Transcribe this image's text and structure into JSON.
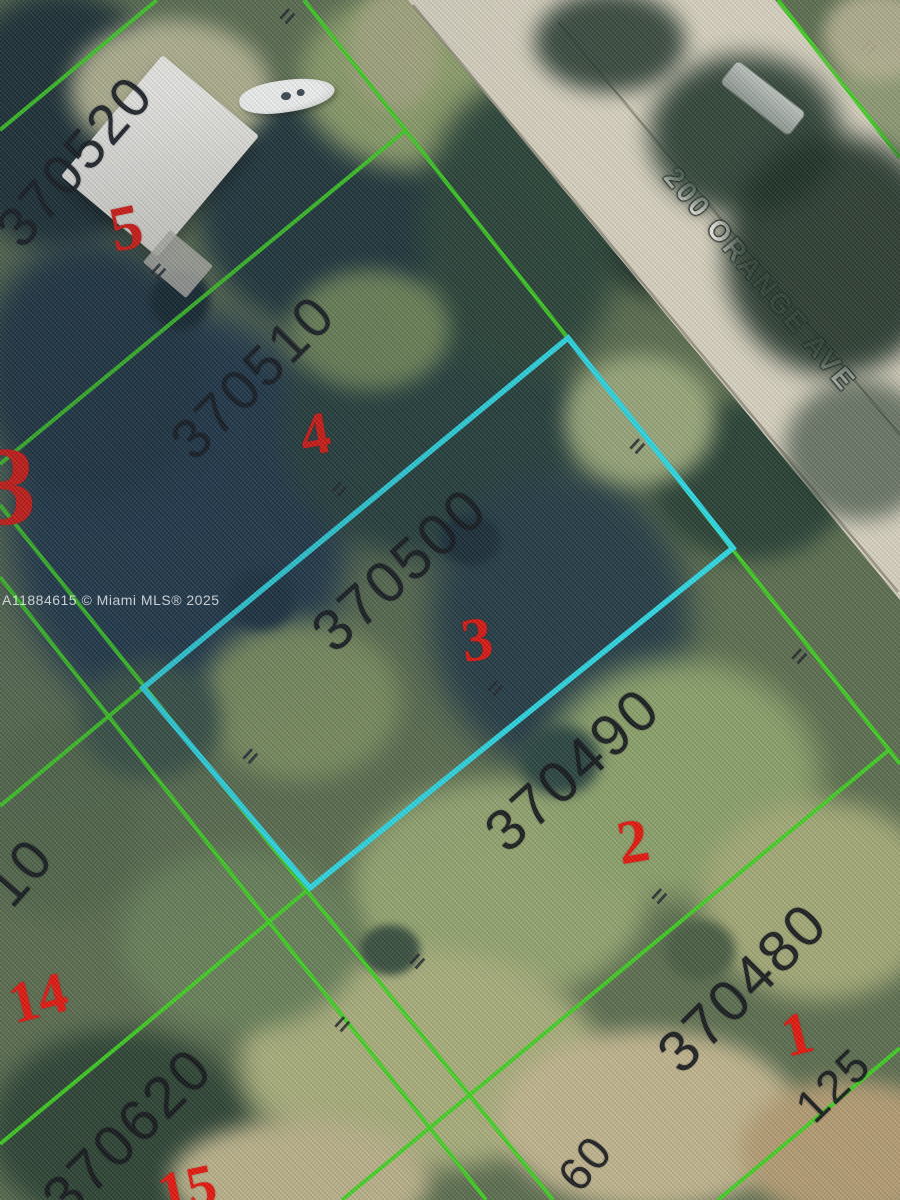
{
  "map": {
    "street_label": "200 ORANGE AVE",
    "watermark": "A11884615 © Miami MLS® 2025",
    "colors": {
      "parcel_line": "#3fd321",
      "highlight": "#2fd9e4",
      "lot_red": "#e3180f",
      "parcel_text": "#15181c",
      "road": "#d7d1bf",
      "road_seam": "rgba(95,90,78,0.5)"
    },
    "parcel_numbers": [
      {
        "t": "370520",
        "x": 75,
        "y": 161,
        "r": -49,
        "s": 56
      },
      {
        "t": "370510",
        "x": 253,
        "y": 377,
        "r": -45,
        "s": 56
      },
      {
        "t": "370500",
        "x": 400,
        "y": 570,
        "r": -42,
        "s": 58
      },
      {
        "t": "370490",
        "x": 573,
        "y": 770,
        "r": -42,
        "s": 58
      },
      {
        "t": "370480",
        "x": 743,
        "y": 988,
        "r": -45,
        "s": 58
      },
      {
        "t": "370620",
        "x": 128,
        "y": 1133,
        "r": -45,
        "s": 58
      },
      {
        "t": "10",
        "x": 20,
        "y": 872,
        "r": -49,
        "s": 56
      }
    ],
    "dimensions": [
      {
        "t": "125",
        "x": 833,
        "y": 1085,
        "r": -44,
        "s": 46
      },
      {
        "t": "60",
        "x": 585,
        "y": 1163,
        "r": -50,
        "s": 46
      }
    ],
    "lot_numbers": [
      {
        "t": "5",
        "x": 126,
        "y": 228,
        "r": -12,
        "s": 64
      },
      {
        "t": "4",
        "x": 315,
        "y": 434,
        "r": -10,
        "s": 60
      },
      {
        "t": "3",
        "x": 477,
        "y": 640,
        "r": -8,
        "s": 62
      },
      {
        "t": "2",
        "x": 633,
        "y": 842,
        "r": -10,
        "s": 62
      },
      {
        "t": "1",
        "x": 797,
        "y": 1034,
        "r": -14,
        "s": 60
      },
      {
        "t": "14",
        "x": 38,
        "y": 998,
        "r": -14,
        "s": 58
      },
      {
        "t": "15",
        "x": 187,
        "y": 1189,
        "r": -12,
        "s": 58
      },
      {
        "t": "3",
        "x": 8,
        "y": 487,
        "r": 0,
        "s": 112
      }
    ],
    "corner_marks": [
      {
        "x": 287,
        "y": 16
      },
      {
        "x": 869,
        "y": 47
      },
      {
        "x": 158,
        "y": 271
      },
      {
        "x": 339,
        "y": 489
      },
      {
        "x": 637,
        "y": 446
      },
      {
        "x": 495,
        "y": 688
      },
      {
        "x": 799,
        "y": 656
      },
      {
        "x": 250,
        "y": 756
      },
      {
        "x": 659,
        "y": 896
      },
      {
        "x": 417,
        "y": 961
      },
      {
        "x": 342,
        "y": 1024
      }
    ],
    "road": {
      "points": "408,0 775,0 900,156 900,600"
    },
    "road_seams": [
      {
        "x1": 413,
        "y1": 5,
        "x2": 898,
        "y2": 592
      },
      {
        "x1": 558,
        "y1": 22,
        "x2": 900,
        "y2": 435
      }
    ],
    "boundary_lines": [
      {
        "x1": 157,
        "y1": 0,
        "x2": 0,
        "y2": 130
      },
      {
        "x1": 406,
        "y1": 130,
        "x2": 0,
        "y2": 464
      },
      {
        "x1": 143,
        "y1": 688,
        "x2": 0,
        "y2": 806
      },
      {
        "x1": 310,
        "y1": 888,
        "x2": 0,
        "y2": 1144
      },
      {
        "x1": 889,
        "y1": 750,
        "x2": 342,
        "y2": 1200
      },
      {
        "x1": 900,
        "y1": 1048,
        "x2": 718,
        "y2": 1200
      },
      {
        "x1": 304,
        "y1": 0,
        "x2": 900,
        "y2": 764
      },
      {
        "x1": 0,
        "y1": 505,
        "x2": 553,
        "y2": 1200
      },
      {
        "x1": 0,
        "y1": 577,
        "x2": 486,
        "y2": 1200
      },
      {
        "x1": 778,
        "y1": 0,
        "x2": 900,
        "y2": 158
      }
    ],
    "highlight_parcel": {
      "points": "568,338 733,548 310,888 143,688"
    }
  }
}
